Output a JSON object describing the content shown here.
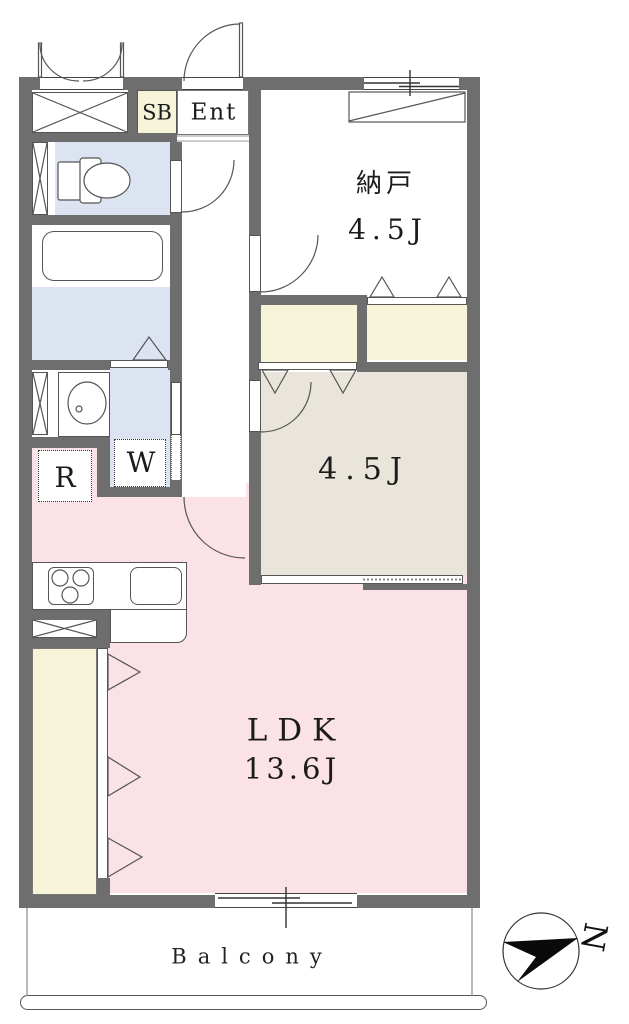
{
  "plan": {
    "title": "apartment floor plan",
    "labels": {
      "sb": "SB",
      "ent": "Ent",
      "nando_name": "納戸",
      "nando_size": "4.5J",
      "western_size": "4.5J",
      "ldk_name": "LDK",
      "ldk_size": "13.6J",
      "fridge": "R",
      "washer": "W",
      "balcony": "Balcony",
      "compass_north": "N"
    },
    "colors": {
      "wall": "#6e6e6e",
      "pink": "#fbe2e6",
      "beige": "#eae5da",
      "cream": "#f6f3d9",
      "blue": "#dce4f2",
      "line": "#555555",
      "ink": "#1b1b1b"
    }
  }
}
